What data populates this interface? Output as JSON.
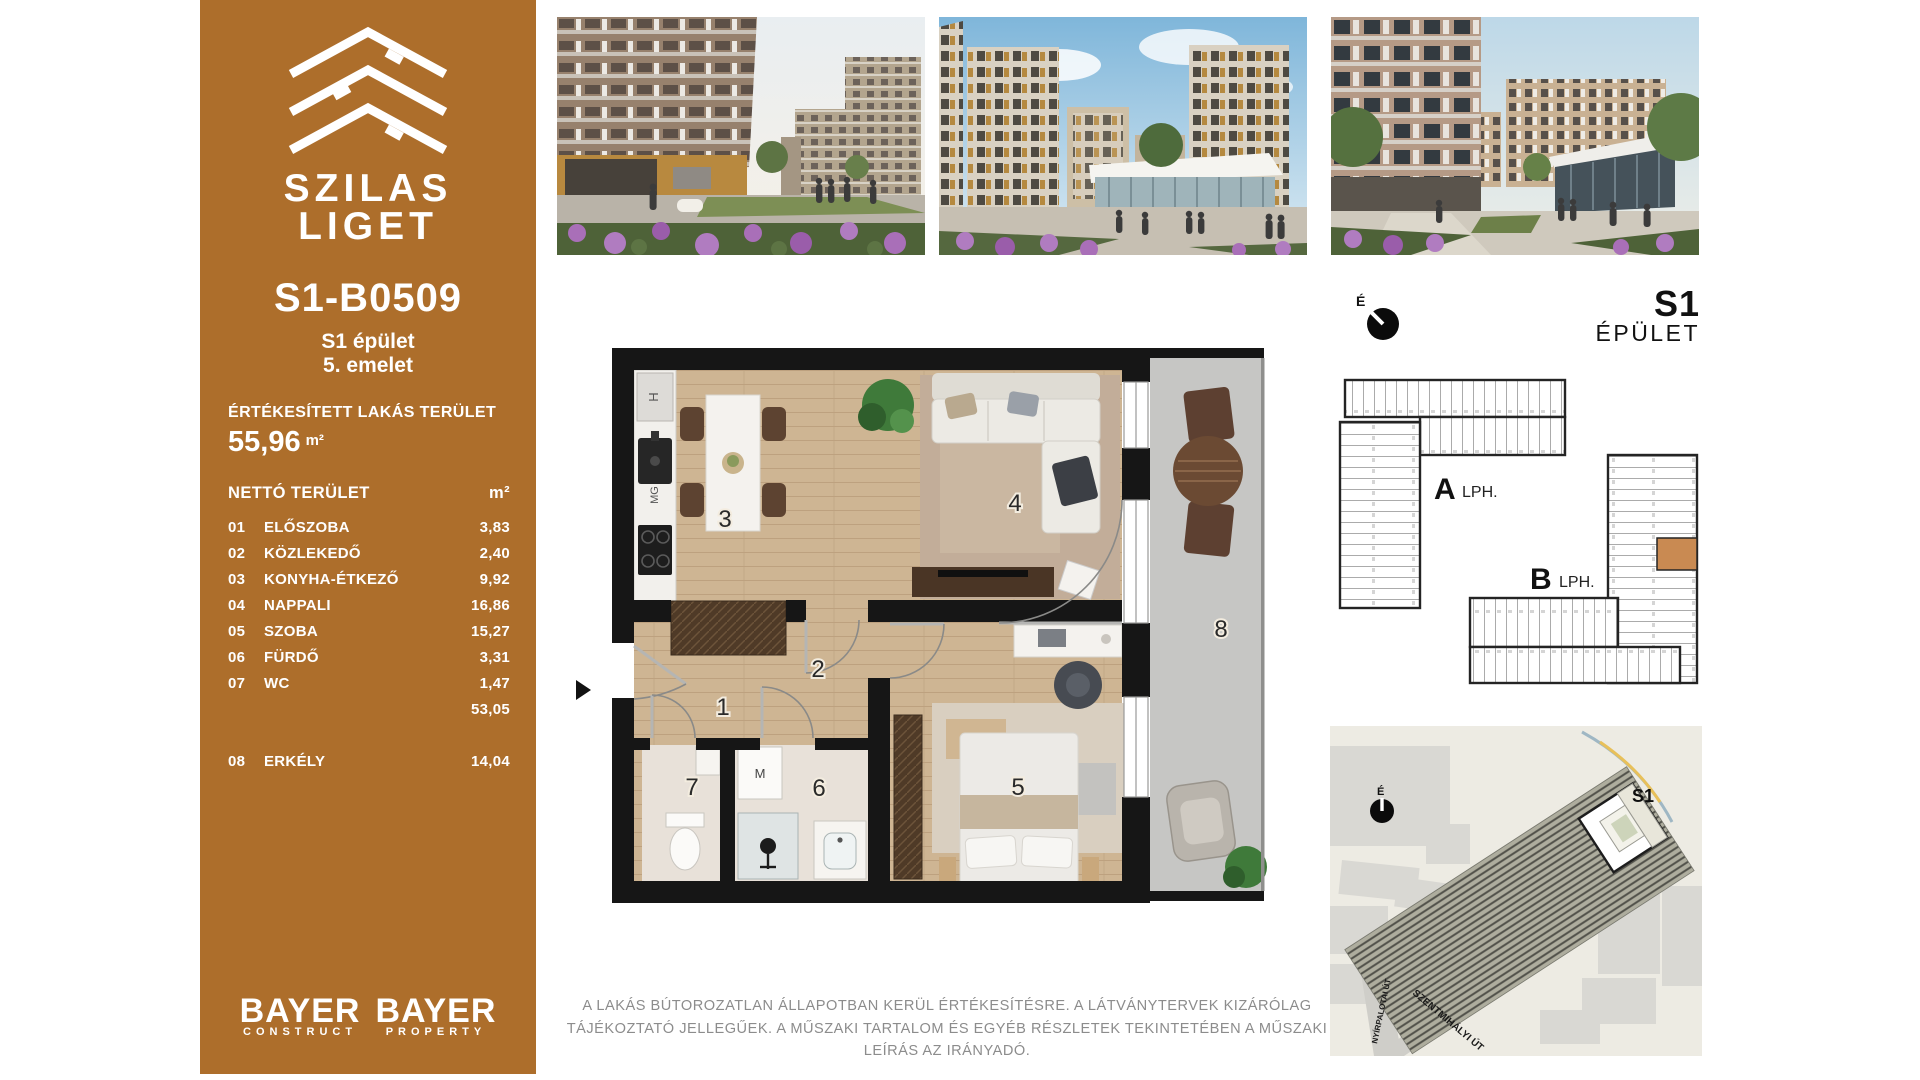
{
  "brand": {
    "name_line1": "SZILAS",
    "name_line2": "LIGET"
  },
  "unit": {
    "id": "S1-B0509",
    "building": "S1 épület",
    "floor": "5. emelet"
  },
  "sold_area": {
    "label": "ÉRTÉKESÍTETT LAKÁS TERÜLET",
    "value": "55,96",
    "unit": "m²"
  },
  "net_area": {
    "label": "NETTÓ TERÜLET",
    "unit_header": "m²",
    "rows": [
      {
        "num": "01",
        "name": "ELŐSZOBA",
        "value": "3,83"
      },
      {
        "num": "02",
        "name": "KÖZLEKEDŐ",
        "value": "2,40"
      },
      {
        "num": "03",
        "name": "KONYHA-ÉTKEZŐ",
        "value": "9,92"
      },
      {
        "num": "04",
        "name": "NAPPALI",
        "value": "16,86"
      },
      {
        "num": "05",
        "name": "SZOBA",
        "value": "15,27"
      },
      {
        "num": "06",
        "name": "FÜRDŐ",
        "value": "3,31"
      },
      {
        "num": "07",
        "name": "WC",
        "value": "1,47"
      }
    ],
    "subtotal": "53,05",
    "balcony_row": {
      "num": "08",
      "name": "ERKÉLY",
      "value": "14,04"
    }
  },
  "developers": [
    {
      "line1": "BAYER",
      "line2": "CONSTRUCT"
    },
    {
      "line1": "BAYER",
      "line2": "PROPERTY"
    }
  ],
  "floor_plan": {
    "rooms": [
      {
        "num": "1"
      },
      {
        "num": "2"
      },
      {
        "num": "3"
      },
      {
        "num": "4"
      },
      {
        "num": "5"
      },
      {
        "num": "6"
      },
      {
        "num": "7"
      },
      {
        "num": "8"
      }
    ],
    "labels": {
      "fridge": "H",
      "microwave": "MG",
      "washer": "M"
    }
  },
  "building_plan": {
    "title_line1": "S1",
    "title_line2": "ÉPÜLET",
    "compass": "É",
    "cores": [
      {
        "bold": "A",
        "rest": "LPH."
      },
      {
        "bold": "B",
        "rest": "LPH."
      }
    ]
  },
  "site_map": {
    "building_label": "S1",
    "compass": "É",
    "streets": [
      "NYÍRPALOTAI ÚT",
      "SZENTMIHÁLYI ÚT"
    ]
  },
  "disclaimer": "A LAKÁS BÚTOROZATLAN ÁLLAPOTBAN KERÜL ÉRTÉKESÍTÉSRE. A LÁTVÁNYTERVEK KIZÁRÓLAG TÁJÉKOZTATÓ JELLEGŰEK. A MŰSZAKI TARTALOM ÉS EGYÉB RÉSZLETEK TEKINTETÉBEN A MŰSZAKI LEÍRÁS AZ IRÁNYADÓ.",
  "colors": {
    "sidebar_bg": "#AD6E2B",
    "highlight_unit": "#C98A52",
    "wall": "#161616",
    "wood_floor": "#CEB593",
    "balcony_floor": "#CBCBC9"
  }
}
